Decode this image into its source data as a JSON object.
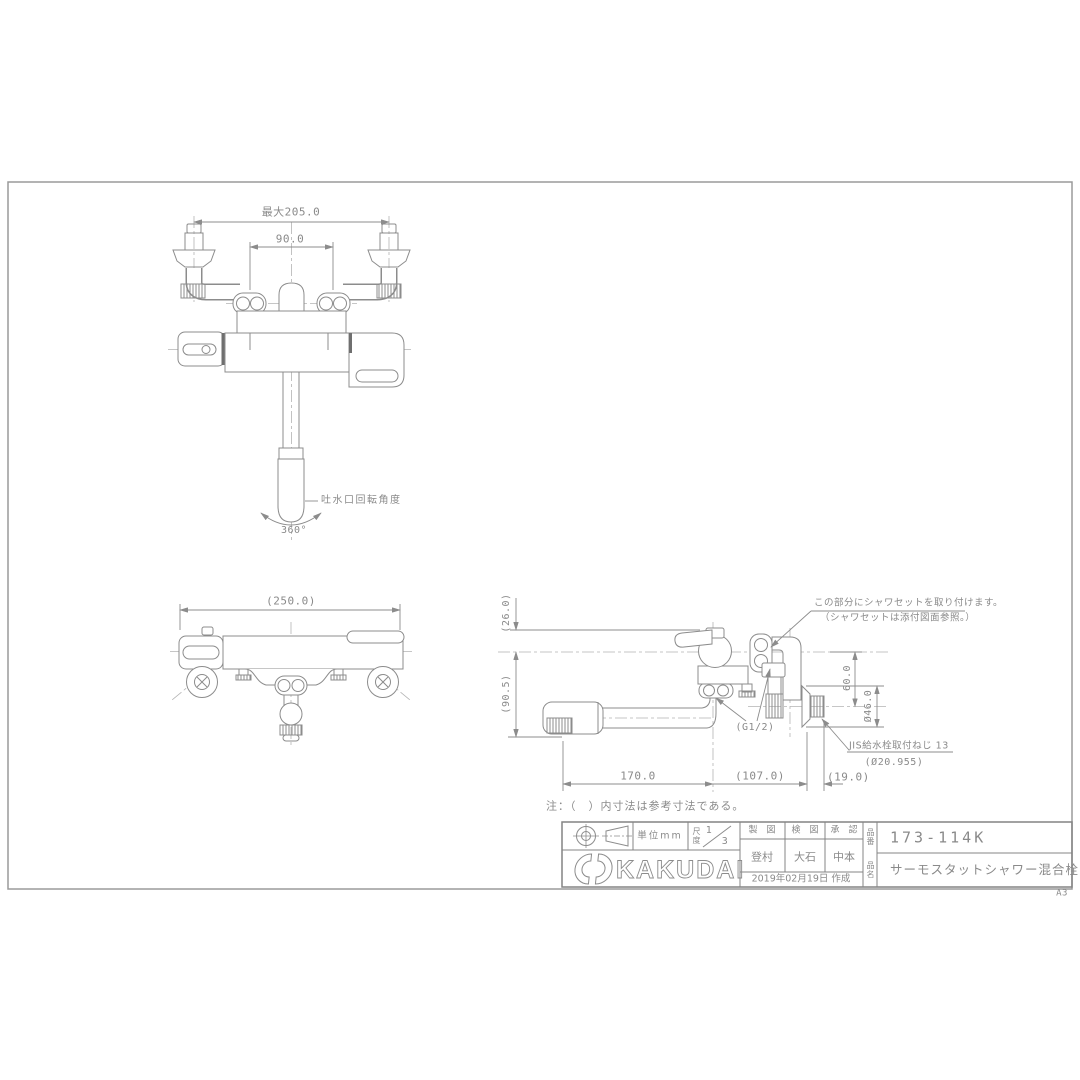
{
  "drawing": {
    "sheet_code": "A3",
    "top_view": {
      "dim_overall_max": "最大205.0",
      "dim_center_spacing": "90.0",
      "spout_label": "吐水口回転角度",
      "spout_angle": "360°"
    },
    "front_view": {
      "dim_width": "(250.0)"
    },
    "side_view": {
      "dim_top": "(26.0)",
      "dim_drop": "(90.5)",
      "dim_riser": "60.0",
      "dim_flange": "Ø46.0",
      "dim_reach": "170.0",
      "dim_body": "(107.0)",
      "dim_nipple": "(19.0)",
      "thread": "(G1/2)",
      "note_shower_1": "この部分にシャワセットを取り付けます。",
      "note_shower_2": "（シャワセットは添付図面参照。）",
      "note_jis_1": "JIS給水栓取付ねじ 13",
      "note_jis_2": "(Ø20.955)"
    },
    "footnote": "注：（　）内寸法は参考寸法である。"
  },
  "title_block": {
    "unit": "単位mm",
    "scale_label": "尺度",
    "scale_numerator": "1",
    "scale_denominator": "3",
    "approval_columns": [
      {
        "header": "製　図",
        "name": "登村"
      },
      {
        "header": "検　図",
        "name": "大石"
      },
      {
        "header": "承　認",
        "name": "中本"
      }
    ],
    "date_created": "2019年02月19日 作成",
    "part_number_label": "品番",
    "part_number": "173-114K",
    "product_name_label": "品名",
    "product_name": "サーモスタットシャワー混合栓",
    "brand": "KAKUDAI"
  }
}
